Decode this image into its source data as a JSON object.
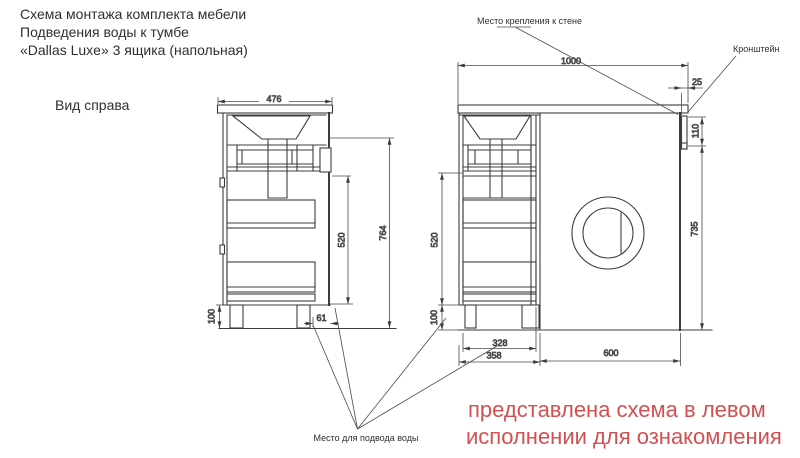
{
  "title": {
    "line1": "Схема монтажа комплекта мебели",
    "line2": "Подведения воды к тумбе",
    "line3": "«Dallas Luxe» 3 ящика (напольная)"
  },
  "view_label": "Вид справа",
  "annotations": {
    "wall_mount": "Место крепления к стене",
    "bracket": "Кронштейн",
    "water_supply": "Место для подвода воды"
  },
  "note": {
    "line1": "представлена схема в левом",
    "line2": "исполнении для ознакомления"
  },
  "dimensions": {
    "side_view": {
      "top_width": "476",
      "drawer_height": "520",
      "total_height": "764",
      "plinth_height": "100",
      "water_offset": "61"
    },
    "front_view": {
      "total_width": "1000",
      "counter_overhang": "25",
      "bracket_height": "110",
      "panel_height": "735",
      "drawer_height": "520",
      "plinth_height": "100",
      "inner_width": "328",
      "cabinet_width": "358",
      "machine_width": "600"
    }
  },
  "colors": {
    "line": "#3c3c3c",
    "text": "#2f2f2f",
    "note_red": "#d25050",
    "background": "#ffffff"
  }
}
